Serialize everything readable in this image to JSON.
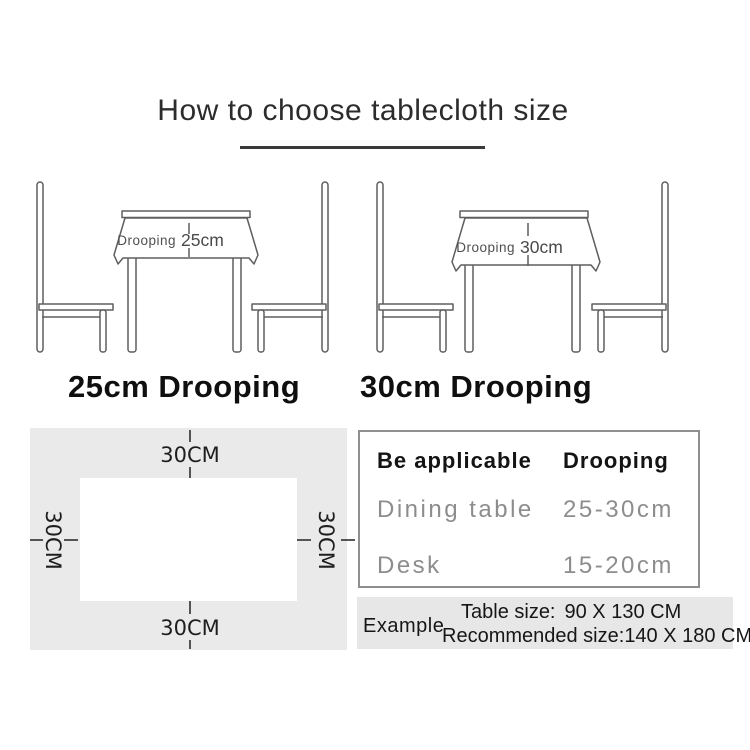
{
  "title": "How to choose tablecloth size",
  "illustrations": [
    {
      "droop_label": "Drooping",
      "droop_value": "25cm",
      "caption": "25cm Drooping"
    },
    {
      "droop_label": "Drooping",
      "droop_value": "30cm",
      "caption": "30cm Drooping"
    }
  ],
  "size_diagram": {
    "top": "30CM",
    "right": "30CM",
    "bottom": "30CM",
    "left": "30CM"
  },
  "spec_table": {
    "header": {
      "col1": "Be applicable",
      "col2": "Drooping"
    },
    "rows": [
      {
        "label": "Dining table",
        "value": "25-30cm"
      },
      {
        "label": "Desk",
        "value": "15-20cm"
      }
    ]
  },
  "example": {
    "label": "Example",
    "table_size_label": "Table size:",
    "table_size_value": "90 X 130 CM",
    "recommended_label": "Recommended size:",
    "recommended_value": "140 X 180 CM"
  },
  "colors": {
    "panel_bg": "#eaeaea",
    "strip_bg": "#e7e7e7",
    "line_art": "#5e5e5e",
    "muted_text": "#8d8d8d",
    "dark_text": "#1e1e1e"
  }
}
